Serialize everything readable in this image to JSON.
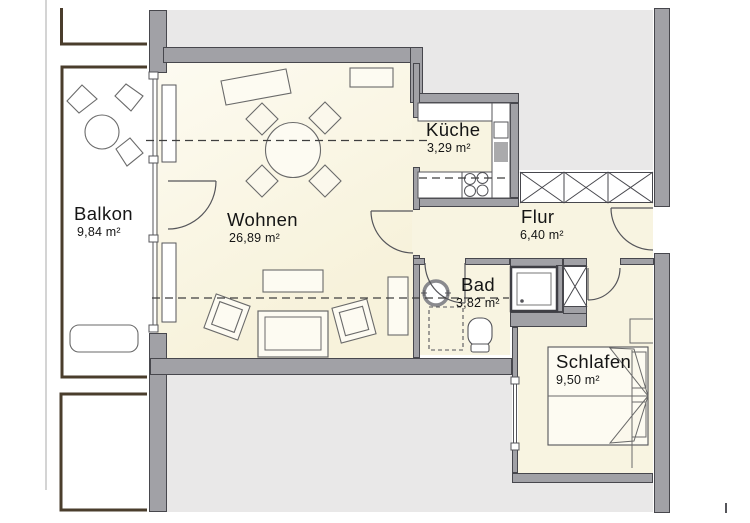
{
  "rooms": [
    {
      "id": "balkon",
      "name": "Balkon",
      "area": "9,84 m²"
    },
    {
      "id": "wohnen",
      "name": "Wohnen",
      "area": "26,89 m²"
    },
    {
      "id": "kueche",
      "name": "Küche",
      "area": "3,29 m²"
    },
    {
      "id": "flur",
      "name": "Flur",
      "area": "6,40 m²"
    },
    {
      "id": "bad",
      "name": "Bad",
      "area": "3,82 m²"
    },
    {
      "id": "schlafen",
      "name": "Schlafen",
      "area": "9,50 m²"
    }
  ],
  "colors": {
    "wall_fill": "#A1A1A6",
    "wall_edge": "#47474D",
    "room_fill": "#F8F4E1",
    "adjacent_fill": "#E9E8E8",
    "balcony_outline": "#4A3D2C",
    "furniture_line": "#6A6A6A",
    "section_dash": "#3F3F3F",
    "page_background": "#FFFFFF"
  }
}
